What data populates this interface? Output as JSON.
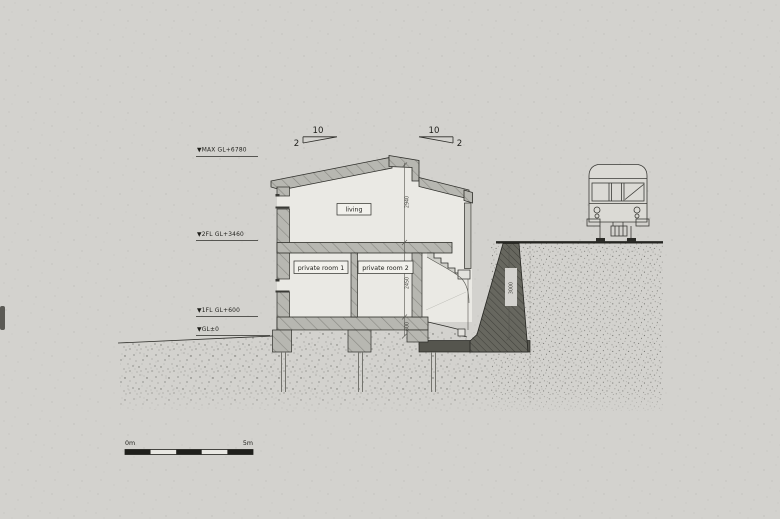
{
  "drawing": {
    "type": "architectural-section",
    "levels": [
      {
        "label": "▼MAX GL+6780"
      },
      {
        "label": "▼2FL GL+3460"
      },
      {
        "label": "▼1FL GL+600"
      },
      {
        "label": "▼GL±0"
      }
    ],
    "rooms": [
      {
        "label": "living"
      },
      {
        "label": "private room 1"
      },
      {
        "label": "private room 2"
      }
    ],
    "roof_slopes": [
      {
        "run": "10",
        "rise": "2"
      },
      {
        "run": "10",
        "rise": "2"
      }
    ],
    "dimensions": [
      {
        "label": "2940"
      },
      {
        "label": "2450"
      },
      {
        "label": "600"
      },
      {
        "label": "3000"
      }
    ],
    "scale_bar": {
      "start_label": "0m",
      "end_label": "5m"
    },
    "colors": {
      "paper": "#d3d2ce",
      "line": "#2d2d29",
      "wall_fill": "#b7b7b1",
      "interior": "#eae9e4",
      "retaining_wall": "#67675f",
      "foundation_mat": "#55554e",
      "soil_dot": "#4e4e49",
      "scale_black": "#1f1f1b"
    }
  }
}
